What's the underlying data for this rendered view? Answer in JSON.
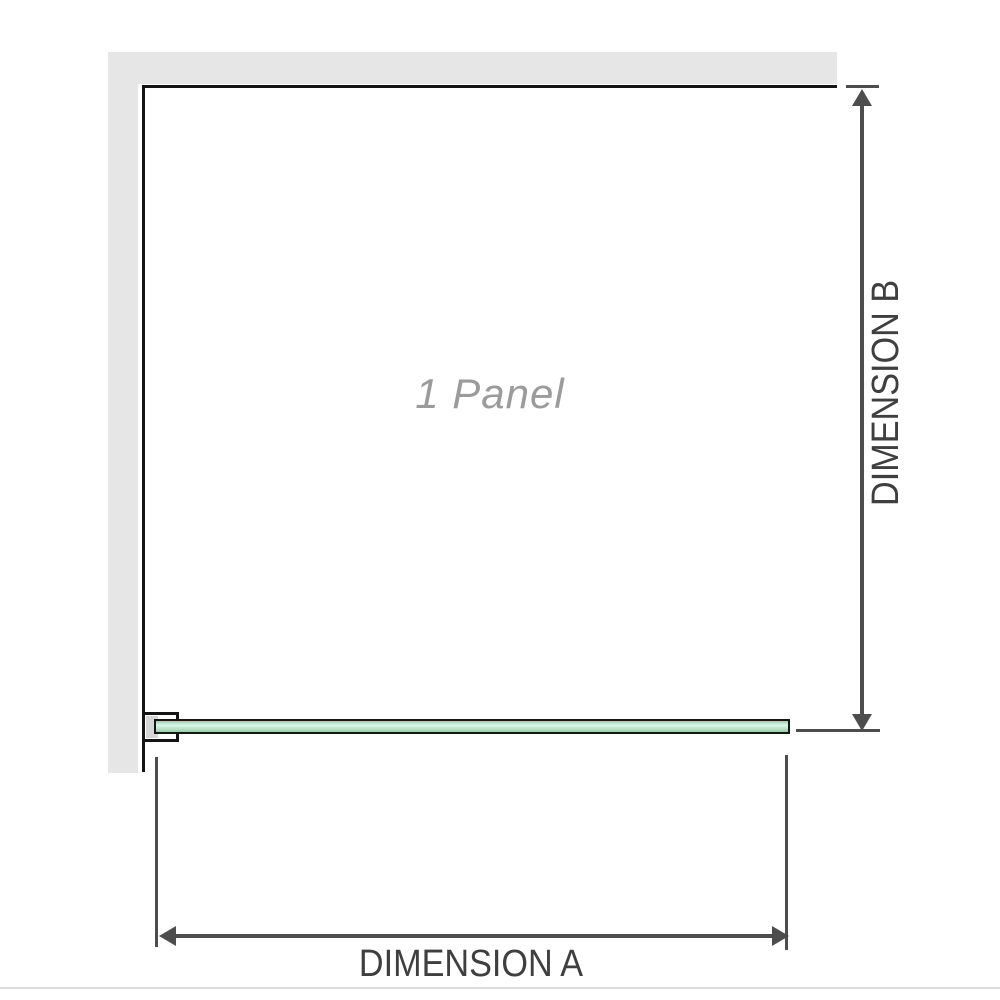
{
  "labels": {
    "panel": "1 Panel",
    "dimension_a": "DIMENSION A",
    "dimension_b": "DIMENSION B"
  },
  "colors": {
    "wall": "#e6e6e6",
    "outline": "#141414",
    "dimline": "#4d4d4d",
    "labeltext": "#3f3f3f",
    "paneltext": "#9b9b9b",
    "glasslight": "#e2f4e8",
    "glassmid": "#bce6ca",
    "glassdark": "#8fd3a9",
    "bracketfill": "#d6d6d6",
    "bottomrule": "#dcdcda"
  }
}
